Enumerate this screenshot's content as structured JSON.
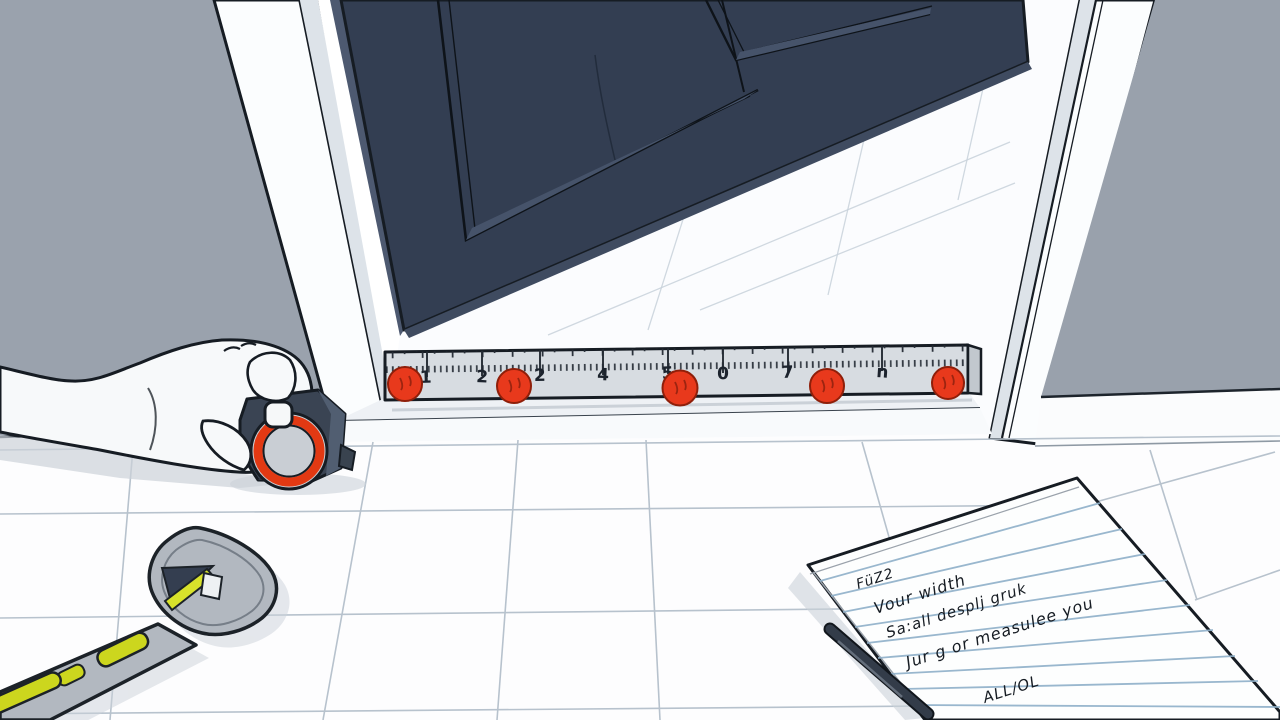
{
  "scene": {
    "description": "Cartoon illustration: a hand holds a tape measure at the base of an open navy door while a ruler with red dots spans the doorway threshold; a spirit level lies on the white tile floor and a notepad with handwritten notes and a pen sits at lower right"
  },
  "ruler": {
    "labels": [
      "1",
      "2",
      "2",
      "4",
      "5",
      "0",
      "7",
      "n"
    ]
  },
  "notepad": {
    "lines": [
      "FüZ2",
      "Vour width",
      "Sa:all desplj gruk",
      "Jur g or measulee you",
      "ALL/OL"
    ]
  },
  "colors": {
    "door": "#333e52",
    "door_edge": "#4d5970",
    "door_bevel": "#46536a",
    "wall_left": "#9aa2ad",
    "wall_right": "#99a1ac",
    "jamb": "#fbfdfe",
    "jamb_shade": "#dde3e9",
    "floor": "#fdfdfe",
    "grout": "#b7c2cd",
    "ruler_body": "#d7dce1",
    "ruler_end": "#c2c8ce",
    "ruler_ink": "#1c232d",
    "dot_red": "#e8391c",
    "dot_red_dark": "#8f1f0a",
    "tape_body": "#3a4453",
    "tape_face": "#515e71",
    "tape_ring": "#e23913",
    "tape_disc": "#c9ced4",
    "level_gray": "#b2b8c0",
    "level_yellow": "#ccd61e",
    "level_dark": "#343e50",
    "paper": "#fdfefe",
    "paper_rule": "#8fb0c9",
    "pen": "#333c49",
    "ink": "#161c23",
    "skin": "#f7f9fa",
    "shadow": "#ccd2d9"
  }
}
